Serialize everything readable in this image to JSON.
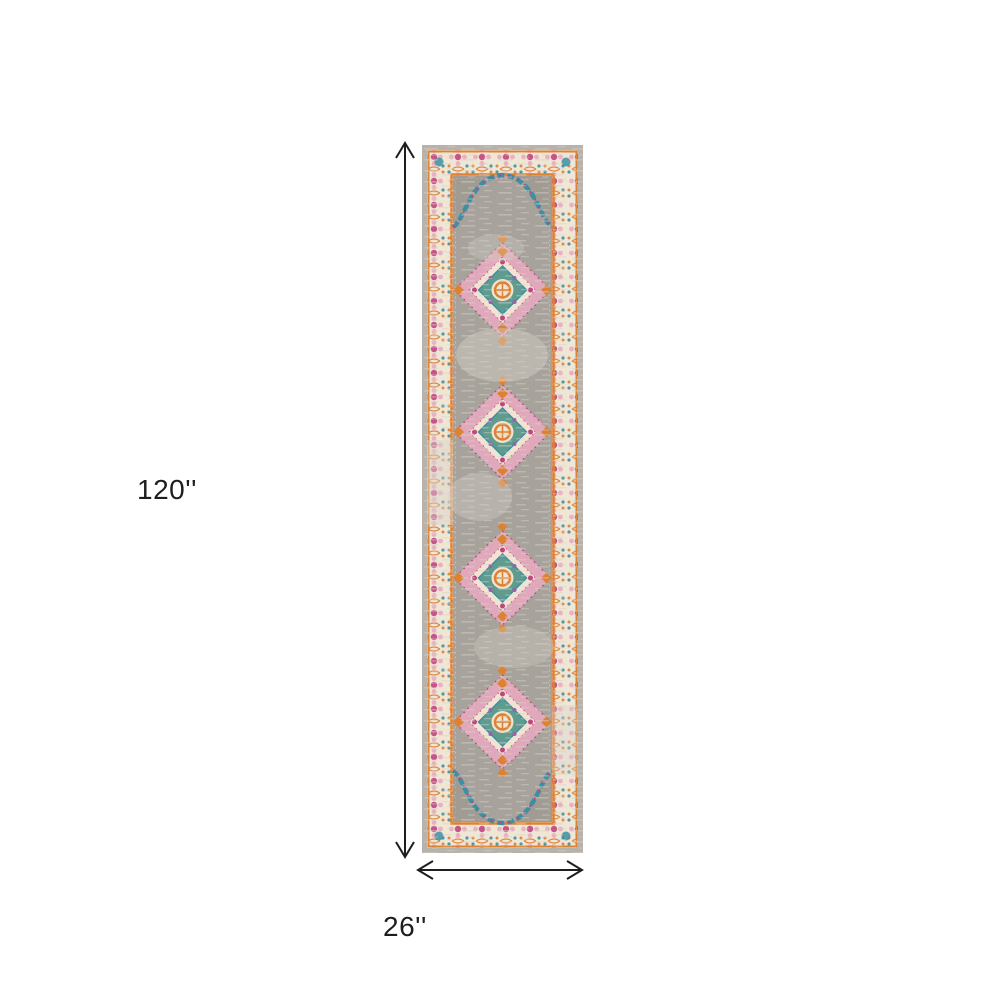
{
  "diagram": {
    "type": "product-dimensions",
    "subject": "vertical runner rug with four medallions, grey field, ornate cream-pink-orange border"
  },
  "dimension_labels": {
    "height": "120''",
    "width": "26''"
  },
  "colors": {
    "background": "#ffffff",
    "label": "#1e1e1e",
    "arrow": "#1e1e1e",
    "rug_edge": "#b7b3ac",
    "rug_border_cream": "#f0e6d6",
    "rug_trim_orange": "#dd8233",
    "rug_field": "#a7a29b",
    "rug_distress": "#d6d2c9",
    "rug_corner": "#99958e",
    "accent_pink": "#e8aabf",
    "accent_magenta": "#c2447e",
    "accent_teal": "#3d8fa3",
    "accent_green_teal": "#5f9c8d",
    "accent_purple": "#9a5fae",
    "medallion_cream": "#f2e4d3"
  }
}
